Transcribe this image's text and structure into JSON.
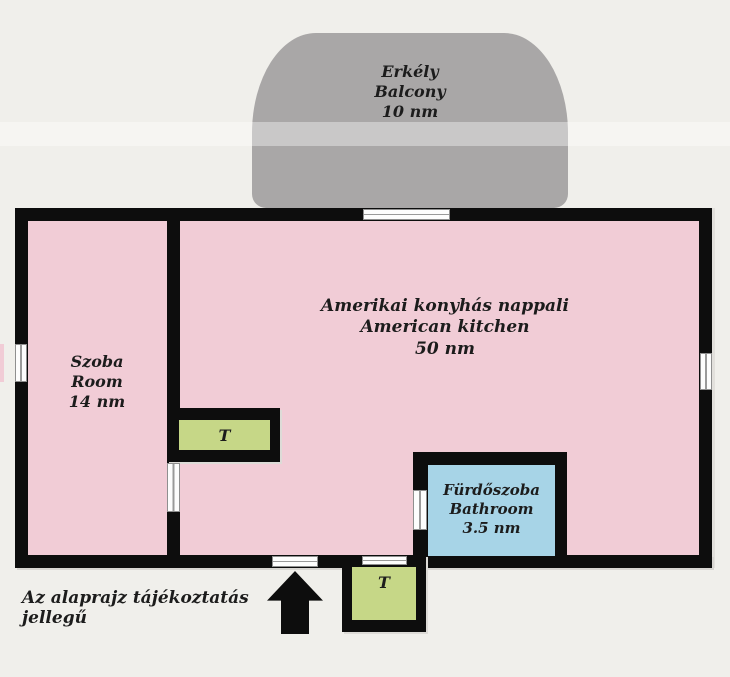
{
  "colors": {
    "background": "#f0efeb",
    "wall": "#0d0d0d",
    "room_pink": "#f1ccd6",
    "balcony_gray": "#a9a7a7",
    "storage_green": "#c6d787",
    "bathroom_blue": "#a7d4e7",
    "window_white": "#fdfdfd",
    "text": "#1c1c1c"
  },
  "rooms": {
    "balcony": {
      "name_hu": "Erkély",
      "name_en": "Balcony",
      "area": "10 nm"
    },
    "living": {
      "name_hu": "Amerikai konyhás nappali",
      "name_en": "American kitchen",
      "area": "50 nm"
    },
    "room": {
      "name_hu": "Szoba",
      "name_en": "Room",
      "area": "14 nm"
    },
    "bathroom": {
      "name_hu": "Fürdőszoba",
      "name_en": "Bathroom",
      "area": "3.5 nm"
    },
    "storage1": {
      "label": "T"
    },
    "storage2": {
      "label": "T"
    }
  },
  "note": "Az alaprajz tájékoztatás jellegű"
}
